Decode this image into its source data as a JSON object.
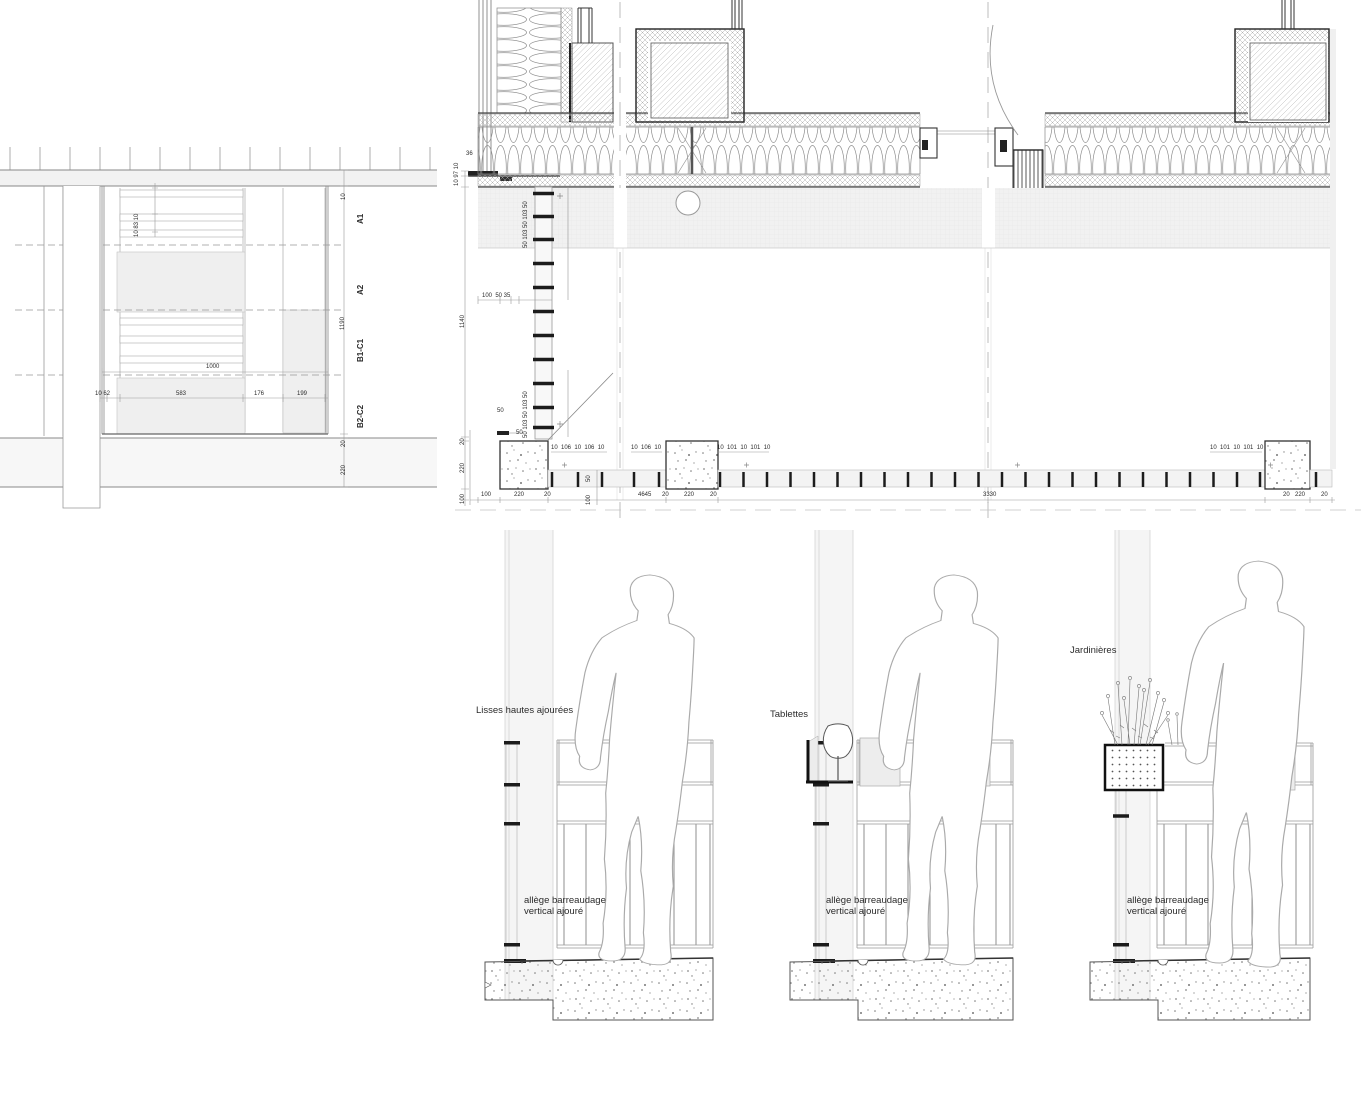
{
  "plan_fragment": {
    "zones": {
      "z1": "A1",
      "z2": "A2",
      "z3": "B1-C1",
      "z4": "B2-C2"
    },
    "dims": {
      "d1": "10 83 10",
      "d2": "10",
      "d3": "1190",
      "d4": "20",
      "d5": "220",
      "d6": "1000",
      "d7": "10 62",
      "d8": "583",
      "d9": "176",
      "d10": "199"
    }
  },
  "facade_detail": {
    "dims": {
      "d1": "36",
      "d2": "10 97 10",
      "d3": "1140",
      "d4": "20",
      "d5": "220",
      "d6": "100",
      "d7": "50 103 50 103 50",
      "d8": "50 103 50 103 50",
      "d9": "100  50 35",
      "d10": "50",
      "d11": "50",
      "d12": "10  106  10  106  10",
      "d13": "10  106  10",
      "d14": "10  101  10  101  10",
      "d15": "10  101  10  101  10",
      "d16": "100",
      "d17": "220",
      "d18": "20",
      "d19": "50",
      "d20": "100",
      "d21": "4645",
      "d22": "20",
      "d23": "220",
      "d24": "20",
      "d25": "3330",
      "d26": "20",
      "d27": "220",
      "d28": "20"
    }
  },
  "elevations": {
    "e1": {
      "label": "Lisses hautes ajourées",
      "note1": "allège barreaudage",
      "note2": "vertical ajouré"
    },
    "e2": {
      "label": "Tablettes",
      "note1": "allège barreaudage",
      "note2": "vertical ajouré"
    },
    "e3": {
      "label": "Jardinières",
      "note1": "allège barreaudage",
      "note2": "vertical ajouré"
    }
  }
}
